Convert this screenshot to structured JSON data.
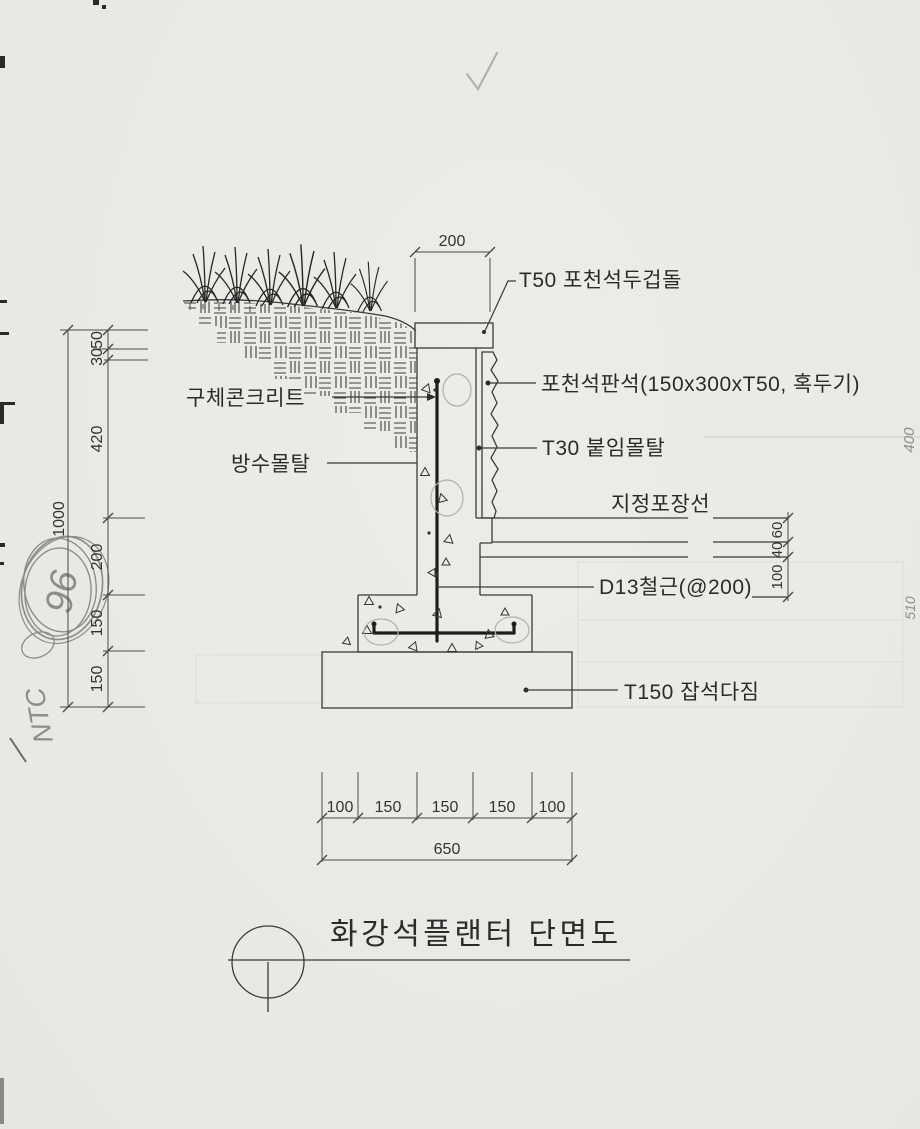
{
  "page": {
    "title": "화강석플랜터 단면도",
    "paper_color": "#eae9e5",
    "ink_color": "#3a3a3a",
    "text_color": "#2b2b2b",
    "pencil_color": "#8e8e88"
  },
  "callouts": {
    "coping": "T50 포천석두겁돌",
    "facing": "포천석판석(150x300xT50, 혹두기)",
    "mortar": "T30 붙임몰탈",
    "paving": "지정포장선",
    "rebar": "D13철근(@200)",
    "rubble": "T150 잡석다짐",
    "concrete": "구체콘크리트",
    "waterproof": "방수몰탈"
  },
  "dimensions": {
    "top_width": "200",
    "left_chain": [
      "50",
      "30",
      "420",
      "200",
      "150",
      "150"
    ],
    "left_total": "1000",
    "right_chain": [
      "60",
      "40",
      "100"
    ],
    "bottom_chain": [
      "100",
      "150",
      "150",
      "150",
      "100"
    ],
    "bottom_total": "650"
  },
  "annotations": {
    "pencil_circled": "96",
    "pencil_note": "NTC",
    "edge_text_upper": "400",
    "edge_text_lower": "510",
    "checkmark": "✓"
  }
}
